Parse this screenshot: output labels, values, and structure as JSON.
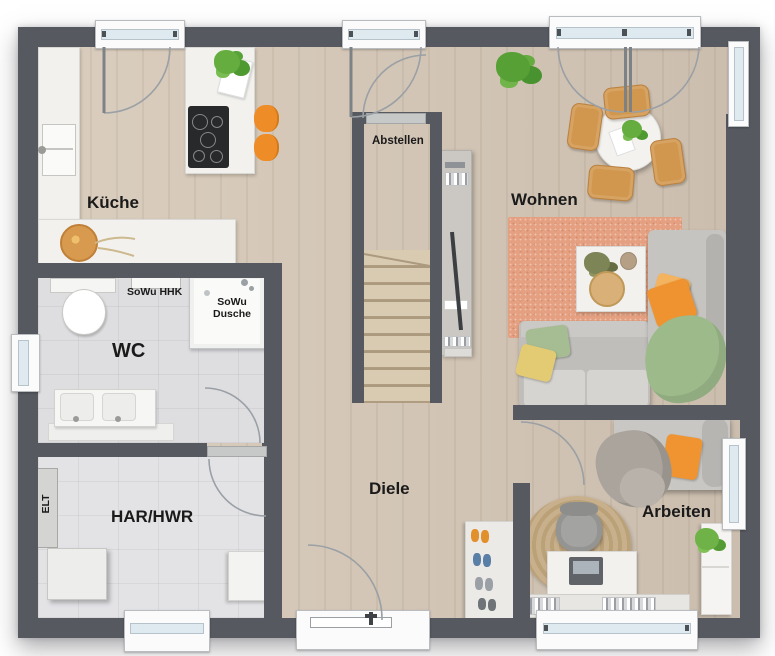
{
  "labels": {
    "kitchen": "Küche",
    "storage": "Abstellen",
    "living": "Wohnen",
    "wc": "WC",
    "wall_heater": "SoWu HHK",
    "shower_line1": "SoWu",
    "shower_line2": "Dusche",
    "hall": "Diele",
    "utility": "HAR/HWR",
    "electrical": "ELT",
    "office": "Arbeiten"
  },
  "palette": {
    "wall": "#565a60",
    "wood_floor": "#d6c8b7",
    "tile_floor": "#e1e1e4",
    "counter_white": "#f2f1ee",
    "rug_salmon": "#e5a081",
    "sofa_gray": "#c0bebb",
    "accent_orange": "#ee8d27",
    "pillow_yellow": "#e3cb73",
    "pillow_green": "#a6bd94",
    "chair_wood": "#d2974e",
    "plant_green": "#5fa838",
    "stair_wood": "#d7c7af",
    "window_glass": "#dfeaf0"
  }
}
